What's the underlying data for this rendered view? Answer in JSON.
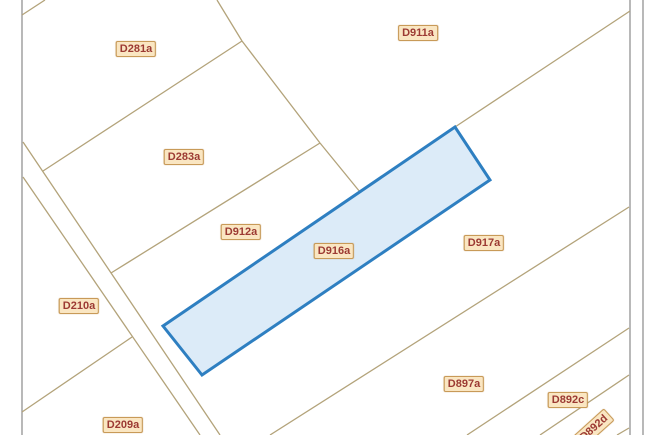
{
  "map": {
    "background": "#ffffff",
    "colors": {
      "parcel_boundary": "#b3a37a",
      "neatline": "#9b9b9b",
      "selection_stroke": "#2e7fc1",
      "selection_fill": "#dcebf8",
      "label_background": "#fae6c2",
      "label_border": "#c89a58",
      "label_text": "#9c3a33"
    },
    "selected_parcel": {
      "id": "D916a",
      "points": [
        [
          455,
          127
        ],
        [
          490,
          180
        ],
        [
          202,
          375
        ],
        [
          163,
          326
        ]
      ]
    },
    "neatlines": [
      {
        "x1": 22,
        "y1": 0,
        "x2": 22,
        "y2": 435
      },
      {
        "x1": 630,
        "y1": 0,
        "x2": 630,
        "y2": 435
      },
      {
        "x1": 643,
        "y1": 0,
        "x2": 643,
        "y2": 435
      }
    ],
    "boundary_lines": [
      {
        "x1": 22,
        "y1": 15,
        "x2": 45,
        "y2": 0
      },
      {
        "x1": 217,
        "y1": 0,
        "x2": 242,
        "y2": 41
      },
      {
        "x1": 242,
        "y1": 41,
        "x2": 320,
        "y2": 143
      },
      {
        "x1": 242,
        "y1": 41,
        "x2": 43,
        "y2": 171
      },
      {
        "x1": 320,
        "y1": 143,
        "x2": 111,
        "y2": 273
      },
      {
        "x1": 320,
        "y1": 143,
        "x2": 360,
        "y2": 192
      },
      {
        "x1": 630,
        "y1": 11,
        "x2": 455,
        "y2": 127
      },
      {
        "x1": 23,
        "y1": 142,
        "x2": 220,
        "y2": 435
      },
      {
        "x1": 23,
        "y1": 177,
        "x2": 200,
        "y2": 435
      },
      {
        "x1": 22,
        "y1": 412,
        "x2": 132,
        "y2": 337
      },
      {
        "x1": 629,
        "y1": 207,
        "x2": 270,
        "y2": 435
      },
      {
        "x1": 629,
        "y1": 328,
        "x2": 467,
        "y2": 435
      },
      {
        "x1": 629,
        "y1": 375,
        "x2": 540,
        "y2": 435
      },
      {
        "x1": 629,
        "y1": 428,
        "x2": 617,
        "y2": 435
      }
    ],
    "labels": [
      {
        "text": "D281a",
        "x": 136,
        "y": 49,
        "rotate": 0,
        "selected": false
      },
      {
        "text": "D911a",
        "x": 418,
        "y": 33,
        "rotate": 0,
        "selected": false
      },
      {
        "text": "D283a",
        "x": 184,
        "y": 157,
        "rotate": 0,
        "selected": false
      },
      {
        "text": "D912a",
        "x": 241,
        "y": 232,
        "rotate": 0,
        "selected": false
      },
      {
        "text": "D916a",
        "x": 334,
        "y": 251,
        "rotate": 0,
        "selected": true
      },
      {
        "text": "D917a",
        "x": 484,
        "y": 243,
        "rotate": 0,
        "selected": false
      },
      {
        "text": "D210a",
        "x": 79,
        "y": 306,
        "rotate": 0,
        "selected": false
      },
      {
        "text": "D897a",
        "x": 464,
        "y": 384,
        "rotate": 0,
        "selected": false
      },
      {
        "text": "D892c",
        "x": 568,
        "y": 400,
        "rotate": 0,
        "selected": false
      },
      {
        "text": "D892d",
        "x": 594,
        "y": 428,
        "rotate": -42,
        "selected": false
      },
      {
        "text": "D209a",
        "x": 123,
        "y": 425,
        "rotate": 0,
        "selected": false
      }
    ]
  }
}
